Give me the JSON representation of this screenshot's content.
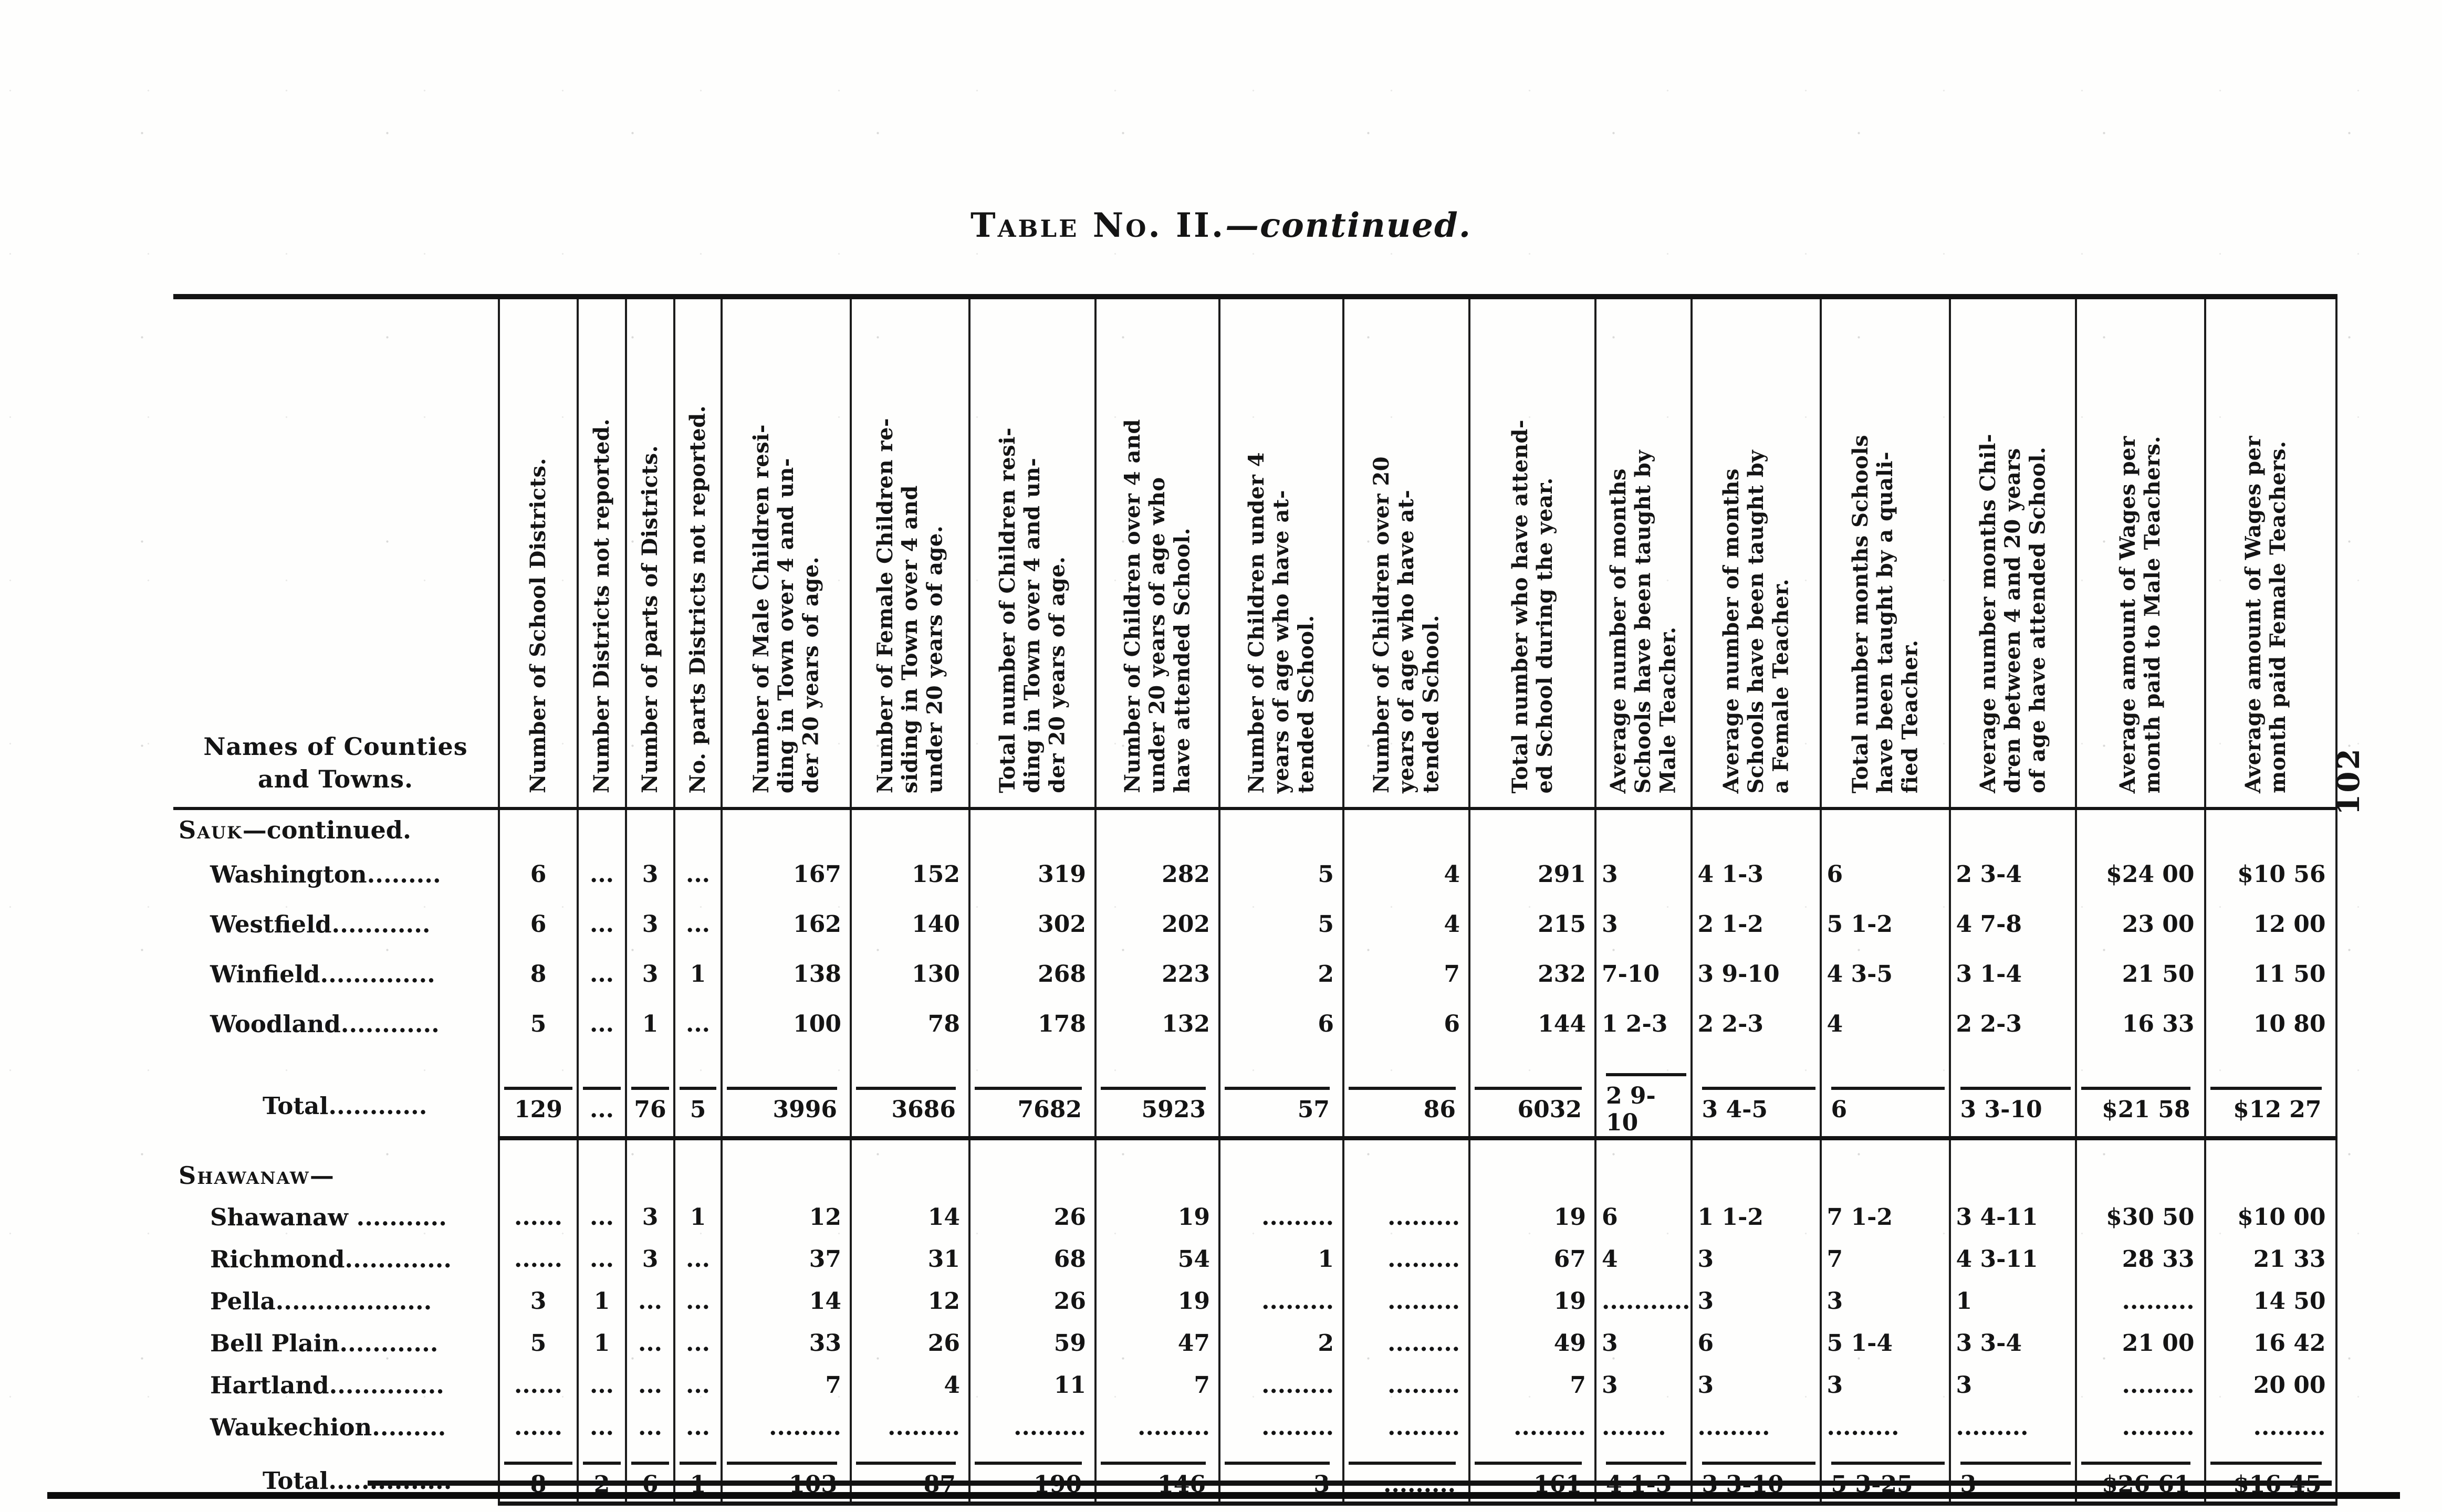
{
  "page": {
    "title_main": "Table No. II.",
    "title_tail": "—continued.",
    "page_number": "102"
  },
  "table": {
    "name_header": "Names of Counties\nand Towns.",
    "columns": [
      {
        "label": "Number of School Districts."
      },
      {
        "label": "Number Districts not reported."
      },
      {
        "label": "Number of parts of Districts."
      },
      {
        "label": "No. parts Districts not reported."
      },
      {
        "label": "Number of Male Children resi-\nding in Town over 4 and un-\nder 20 years of age."
      },
      {
        "label": "Number of Female Children re-\nsiding in Town over 4 and\nunder 20 years of age."
      },
      {
        "label": "Total number of Children resi-\nding in Town over 4 and un-\nder 20 years of age."
      },
      {
        "label": "Number of Children over 4 and\nunder 20 years of age who\nhave attended School."
      },
      {
        "label": "Number of Children under 4\nyears of age who have at-\ntended School."
      },
      {
        "label": "Number of Children over 20\nyears of age who have at-\ntended School."
      },
      {
        "label": "Total number who have attend-\ned School during the year."
      },
      {
        "label": "Average number of months\nSchools have been taught by\nMale Teacher."
      },
      {
        "label": "Average number of months\nSchools have been taught by\na Female Teacher."
      },
      {
        "label": "Total number months Schools\nhave been taught by a quali-\nfied Teacher."
      },
      {
        "label": "Average number months Chil-\ndren between 4 and 20 years\nof age have attended School."
      },
      {
        "label": "Average amount of Wages per\nmonth paid to Male Teachers."
      },
      {
        "label": "Average amount of Wages per\nmonth paid Female Teachers."
      }
    ],
    "sections": [
      {
        "heading_caps": "Sauk",
        "heading_rest": "—continued.",
        "rows": [
          {
            "name": "Washington.........",
            "values": [
              "6",
              "...",
              "3",
              "...",
              "167",
              "152",
              "319",
              "282",
              "5",
              "4",
              "291",
              "3",
              "4 1-3",
              "6",
              "2 3-4",
              "$24 00",
              "$10 56"
            ]
          },
          {
            "name": "Westfield............",
            "values": [
              "6",
              "...",
              "3",
              "...",
              "162",
              "140",
              "302",
              "202",
              "5",
              "4",
              "215",
              "3",
              "2 1-2",
              "5 1-2",
              "4 7-8",
              "23 00",
              "12 00"
            ]
          },
          {
            "name": "Winfield..............",
            "values": [
              "8",
              "...",
              "3",
              "1",
              "138",
              "130",
              "268",
              "223",
              "2",
              "7",
              "232",
              "7-10",
              "3 9-10",
              "4 3-5",
              "3 1-4",
              "21 50",
              "11 50"
            ]
          },
          {
            "name": "Woodland............",
            "values": [
              "5",
              "...",
              "1",
              "...",
              "100",
              "78",
              "178",
              "132",
              "6",
              "6",
              "144",
              "1 2-3",
              "2 2-3",
              "4",
              "2 2-3",
              "16 33",
              "10 80"
            ]
          }
        ],
        "total": {
          "name": "Total............",
          "values": [
            "129",
            "...",
            "76",
            "5",
            "3996",
            "3686",
            "7682",
            "5923",
            "57",
            "86",
            "6032",
            "2 9-10",
            "3 4-5",
            "6",
            "3 3-10",
            "$21 58",
            "$12 27"
          ]
        }
      },
      {
        "heading_caps": "Shawanaw",
        "heading_rest": "—",
        "rows": [
          {
            "name": "Shawanaw ...........",
            "values": [
              "......",
              "...",
              "3",
              "1",
              "12",
              "14",
              "26",
              "19",
              ".........",
              ".........",
              "19",
              "6",
              "1 1-2",
              "7 1-2",
              "3 4-11",
              "$30 50",
              "$10 00"
            ]
          },
          {
            "name": "Richmond.............",
            "values": [
              "......",
              "...",
              "3",
              "...",
              "37",
              "31",
              "68",
              "54",
              "1",
              ".........",
              "67",
              "4",
              "3",
              "7",
              "4 3-11",
              "28 33",
              "21 33"
            ]
          },
          {
            "name": "Pella...................",
            "values": [
              "3",
              "1",
              "...",
              "...",
              "14",
              "12",
              "26",
              "19",
              ".........",
              ".........",
              "19",
              "...........",
              "3",
              "3",
              "1",
              ".........",
              "14 50"
            ]
          },
          {
            "name": "Bell Plain............",
            "values": [
              "5",
              "1",
              "...",
              "...",
              "33",
              "26",
              "59",
              "47",
              "2",
              ".........",
              "49",
              "3",
              "6",
              "5 1-4",
              "3 3-4",
              "21 00",
              "16 42"
            ]
          },
          {
            "name": "Hartland..............",
            "values": [
              "......",
              "...",
              "...",
              "...",
              "7",
              "4",
              "11",
              "7",
              ".........",
              ".........",
              "7",
              "3",
              "3",
              "3",
              "3",
              ".........",
              "20 00"
            ]
          },
          {
            "name": "Waukechion.........",
            "values": [
              "......",
              "...",
              "...",
              "...",
              ".........",
              ".........",
              ".........",
              ".........",
              ".........",
              ".........",
              ".........",
              "........",
              ".........",
              ".........",
              ".........",
              ".........",
              "........."
            ]
          }
        ],
        "total": {
          "name": "Total...............",
          "values": [
            "8",
            "2",
            "6",
            "1",
            "103",
            "87",
            "190",
            "146",
            "3",
            ".........",
            "161",
            "4 1-3",
            "3 3-10",
            "5 3-25",
            "3",
            "$26 61",
            "$16 45"
          ]
        }
      }
    ]
  }
}
